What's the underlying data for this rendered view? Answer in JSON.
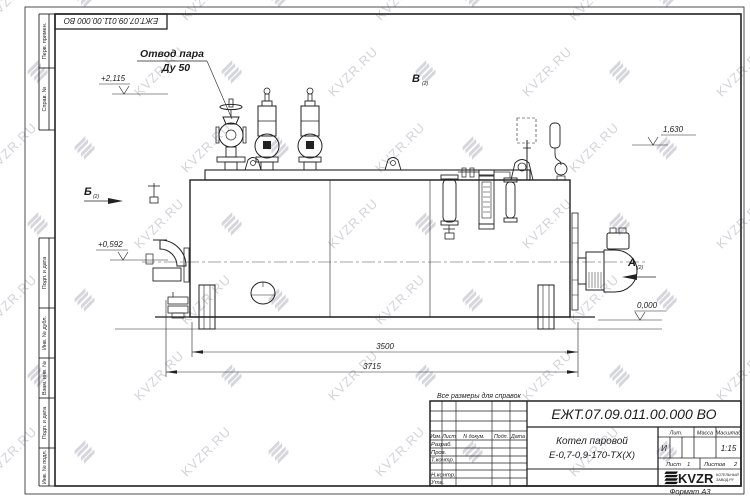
{
  "watermark": {
    "text": "KVZR.RU"
  },
  "sheet": {
    "note": "Все размеры для справок",
    "format_label": "Формат А3"
  },
  "margin_labels": [
    "Перв. примен.",
    "Справ. №",
    "Подп. и дата",
    "Инв. № дубл.",
    "Взам. инв. №",
    "Подп. и дата",
    "Инв. № подл."
  ],
  "drawing": {
    "callout_line1": "Отвод пара",
    "callout_line2": "Ду 50",
    "view_a": "А",
    "view_a_sub": "(2)",
    "view_b": "Б",
    "view_b_sub": "(2)",
    "view_v": "В",
    "view_v_sub": "(2)",
    "elevation_top": "+2,115",
    "elevation_right": "1,630",
    "elevation_left": "+0,592",
    "elevation_zero": "0,000",
    "dim_inner": "3500",
    "dim_outer": "3715"
  },
  "title_block": {
    "doc_number": "ЕЖТ.07.09.011.00.000  ВО",
    "product_name_line1": "Котел паровой",
    "product_name_line2": "Е-0,7-0,9-170-ТХ(Х)",
    "col_izm": "Изм.",
    "col_list": "Лист",
    "col_ndoc": "N докум.",
    "col_podp": "Подп.",
    "col_data": "Дата",
    "row_razrab": "Разраб.",
    "row_prov": "Пров.",
    "row_tkontr": "Т.контр.",
    "row_nkontr": "Н.контр.",
    "row_utv": "Утв.",
    "lit_header": "Лит.",
    "mass_header": "Масса",
    "scale_header": "Масштаб",
    "lit_value": "И",
    "scale_value": "1:15",
    "sheet_label": "Лист",
    "sheet_value": "1",
    "sheets_label": "Листов",
    "sheets_value": "2",
    "logo_text": "KVZR",
    "logo_sub1": "КОТЕЛЬНЫЙ",
    "logo_sub2": "ЗАВОД.РУ"
  }
}
